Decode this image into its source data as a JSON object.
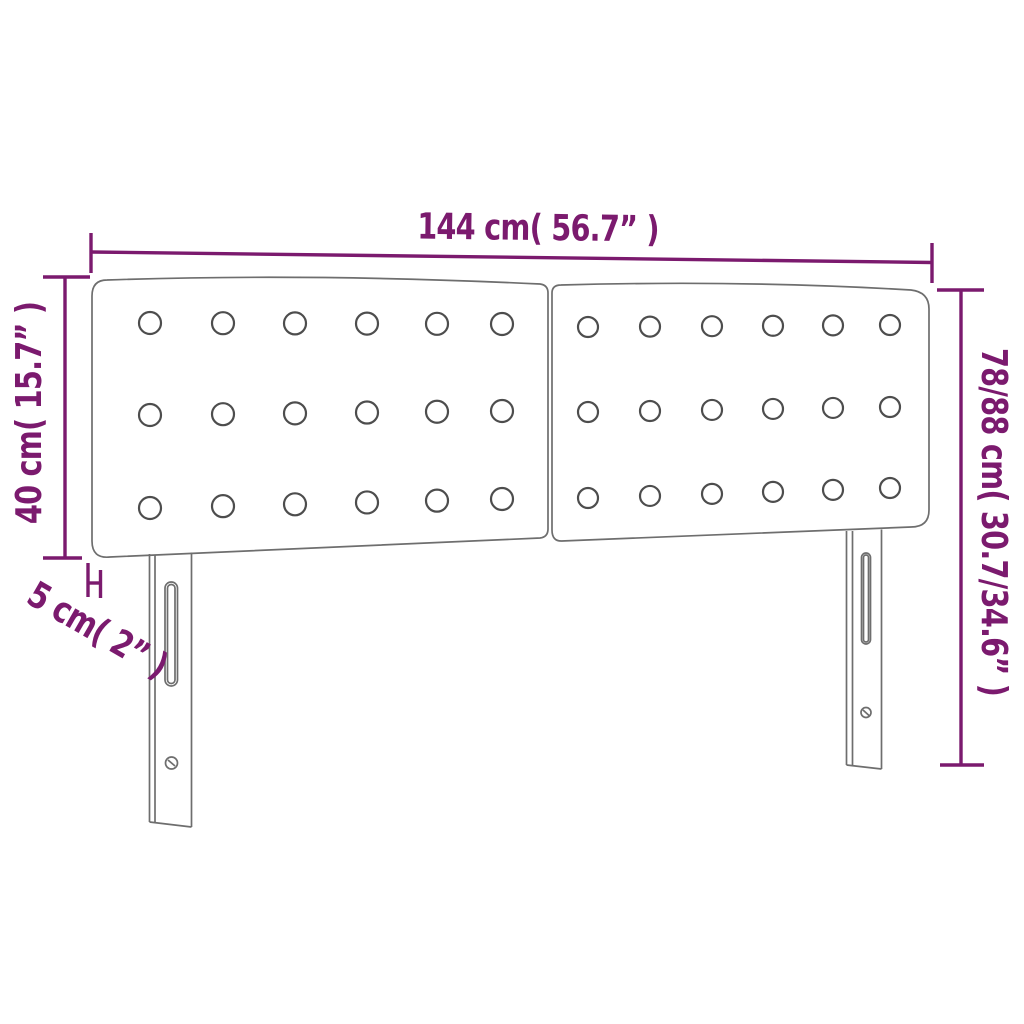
{
  "diagram": {
    "type": "product-dimension-diagram",
    "subject": "upholstered-headboard-with-two-panels-and-two-legs",
    "colors": {
      "accent": "#7b1a6e",
      "line": "#6e6e6e",
      "background": "#ffffff"
    },
    "dimensions": {
      "width_label": "144 cm( 56.7” )",
      "height_left_label": "40 cm( 15.7” )",
      "height_right_label": "78/88 cm( 30.7/34.6” )",
      "thickness_label": "5 cm( 2” )"
    },
    "panels": {
      "count": 2,
      "button_rows": 3,
      "button_cols": 6
    },
    "legs": {
      "count": 2
    }
  }
}
